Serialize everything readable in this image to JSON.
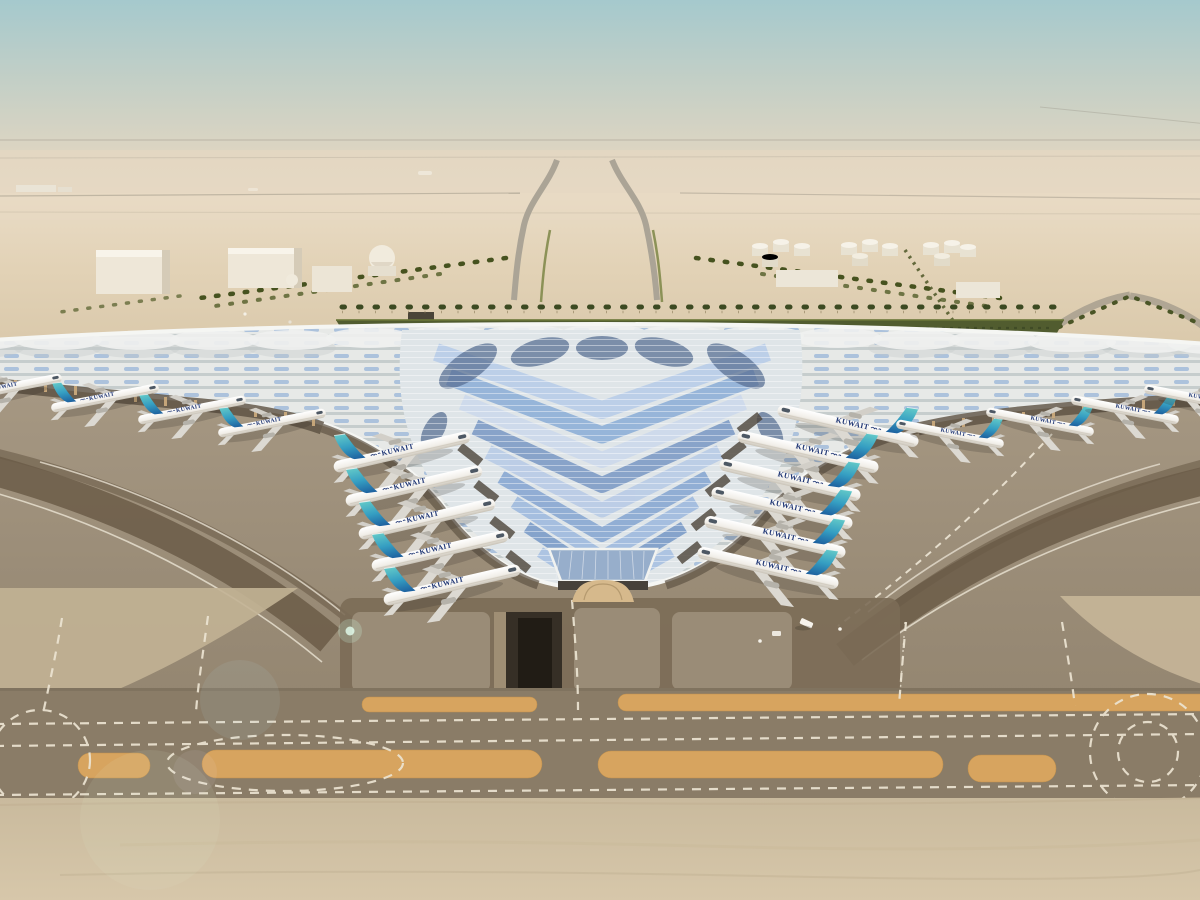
{
  "scene": {
    "description": "Aerial architectural rendering of a desert airport: trident-shaped terminal with swooping silver roof and blue photovoltaic skylight chevrons, aircraft parked at gates, palm-lined approach roads, fuel tank farm, warehouses, and parallel taxiways with white dashed centerlines and orange sand infill strips",
    "sky": {
      "top_color": "#a5c9cd",
      "horizon_color": "#e8dac4"
    },
    "aircraft": {
      "livery_text": "KUWAIT",
      "livery_arabic": "الكويتية",
      "count_visible": 19,
      "count_left_gate_row": 5,
      "count_right_gate_row": 6,
      "count_left_wing_row": 4,
      "count_right_wing_row": 4,
      "fuselage_color": "#f2efe9",
      "tail_gradient_top": "#63c9c8",
      "tail_gradient_bottom": "#1d5f9e",
      "livery_text_color": "#1f3674"
    },
    "terminal": {
      "roof_color": "#e9ebe9",
      "skylight_blue": "#8fb0d8",
      "chevron_dark_blue": "#5a7094",
      "column_color": "#d2b489",
      "glass_color": "#97aecb"
    },
    "ground": {
      "desert_sand": "#e2d2b6",
      "apron_concrete": "#9c8e7a",
      "taxiway_color": "#8a7c67",
      "sand_strip_orange": "#d7a45f",
      "dark_lane_brown": "#6b5c48",
      "marking_color": "#ece4d2",
      "greenery_color": "#515c2f"
    },
    "landside": {
      "fuel_tanks": 12,
      "warehouses": 5,
      "dome_buildings": 2
    }
  }
}
